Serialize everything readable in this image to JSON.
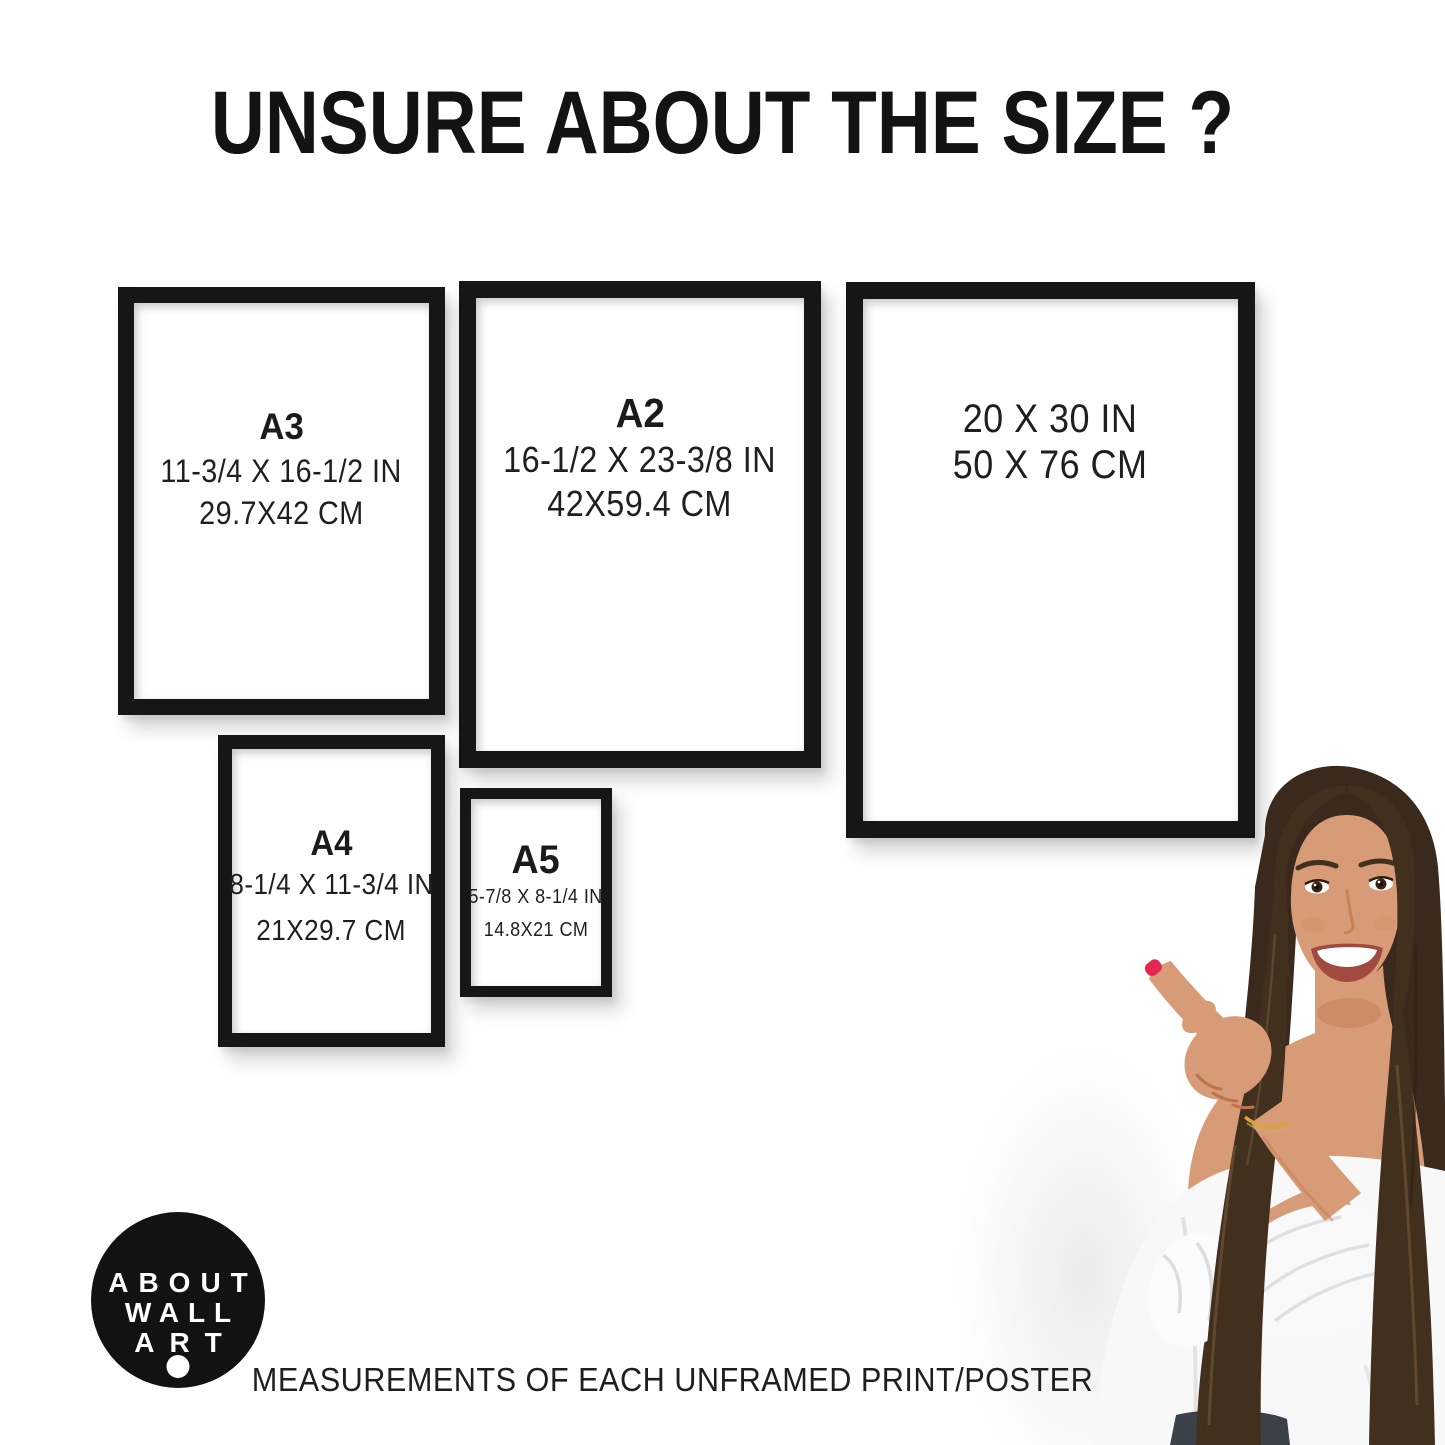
{
  "title": "UNSURE ABOUT THE SIZE ?",
  "frames": [
    {
      "label": "A3",
      "inches": "11-3/4 X 16-1/2 IN",
      "cm": "29.7X42 CM"
    },
    {
      "label": "A2",
      "inches": "16-1/2 X 23-3/8 IN",
      "cm": "42X59.4 CM"
    },
    {
      "label": "",
      "inches": "20 X 30 IN",
      "cm": "50 X 76 CM"
    },
    {
      "label": "A4",
      "inches": "8-1/4 X 11-3/4 IN",
      "cm": "21X29.7 CM"
    },
    {
      "label": "A5",
      "inches": "5-7/8 X 8-1/4 IN",
      "cm": "14.8X21 CM"
    }
  ],
  "logo": {
    "line1": "ABOUT",
    "line2": "WALL",
    "line3": "ART"
  },
  "caption": "MEASUREMENTS OF EACH UNFRAMED PRINT/POSTER",
  "colors": {
    "frame_border": "#161616",
    "logo_background": "#121212",
    "text": "#1f1f1f",
    "hair": "#3a2a1d",
    "hair_front": "#42301f",
    "hair_highlight": "#6f5135",
    "skin": "#d89b77",
    "skin_shadow": "#c07a54",
    "blouse": "#f8f8f8",
    "jeans": "#3b4149",
    "nail": "#e72752",
    "bracelet": "#d9a23a",
    "lips": "#a14a3f",
    "teeth": "#ffffff"
  }
}
